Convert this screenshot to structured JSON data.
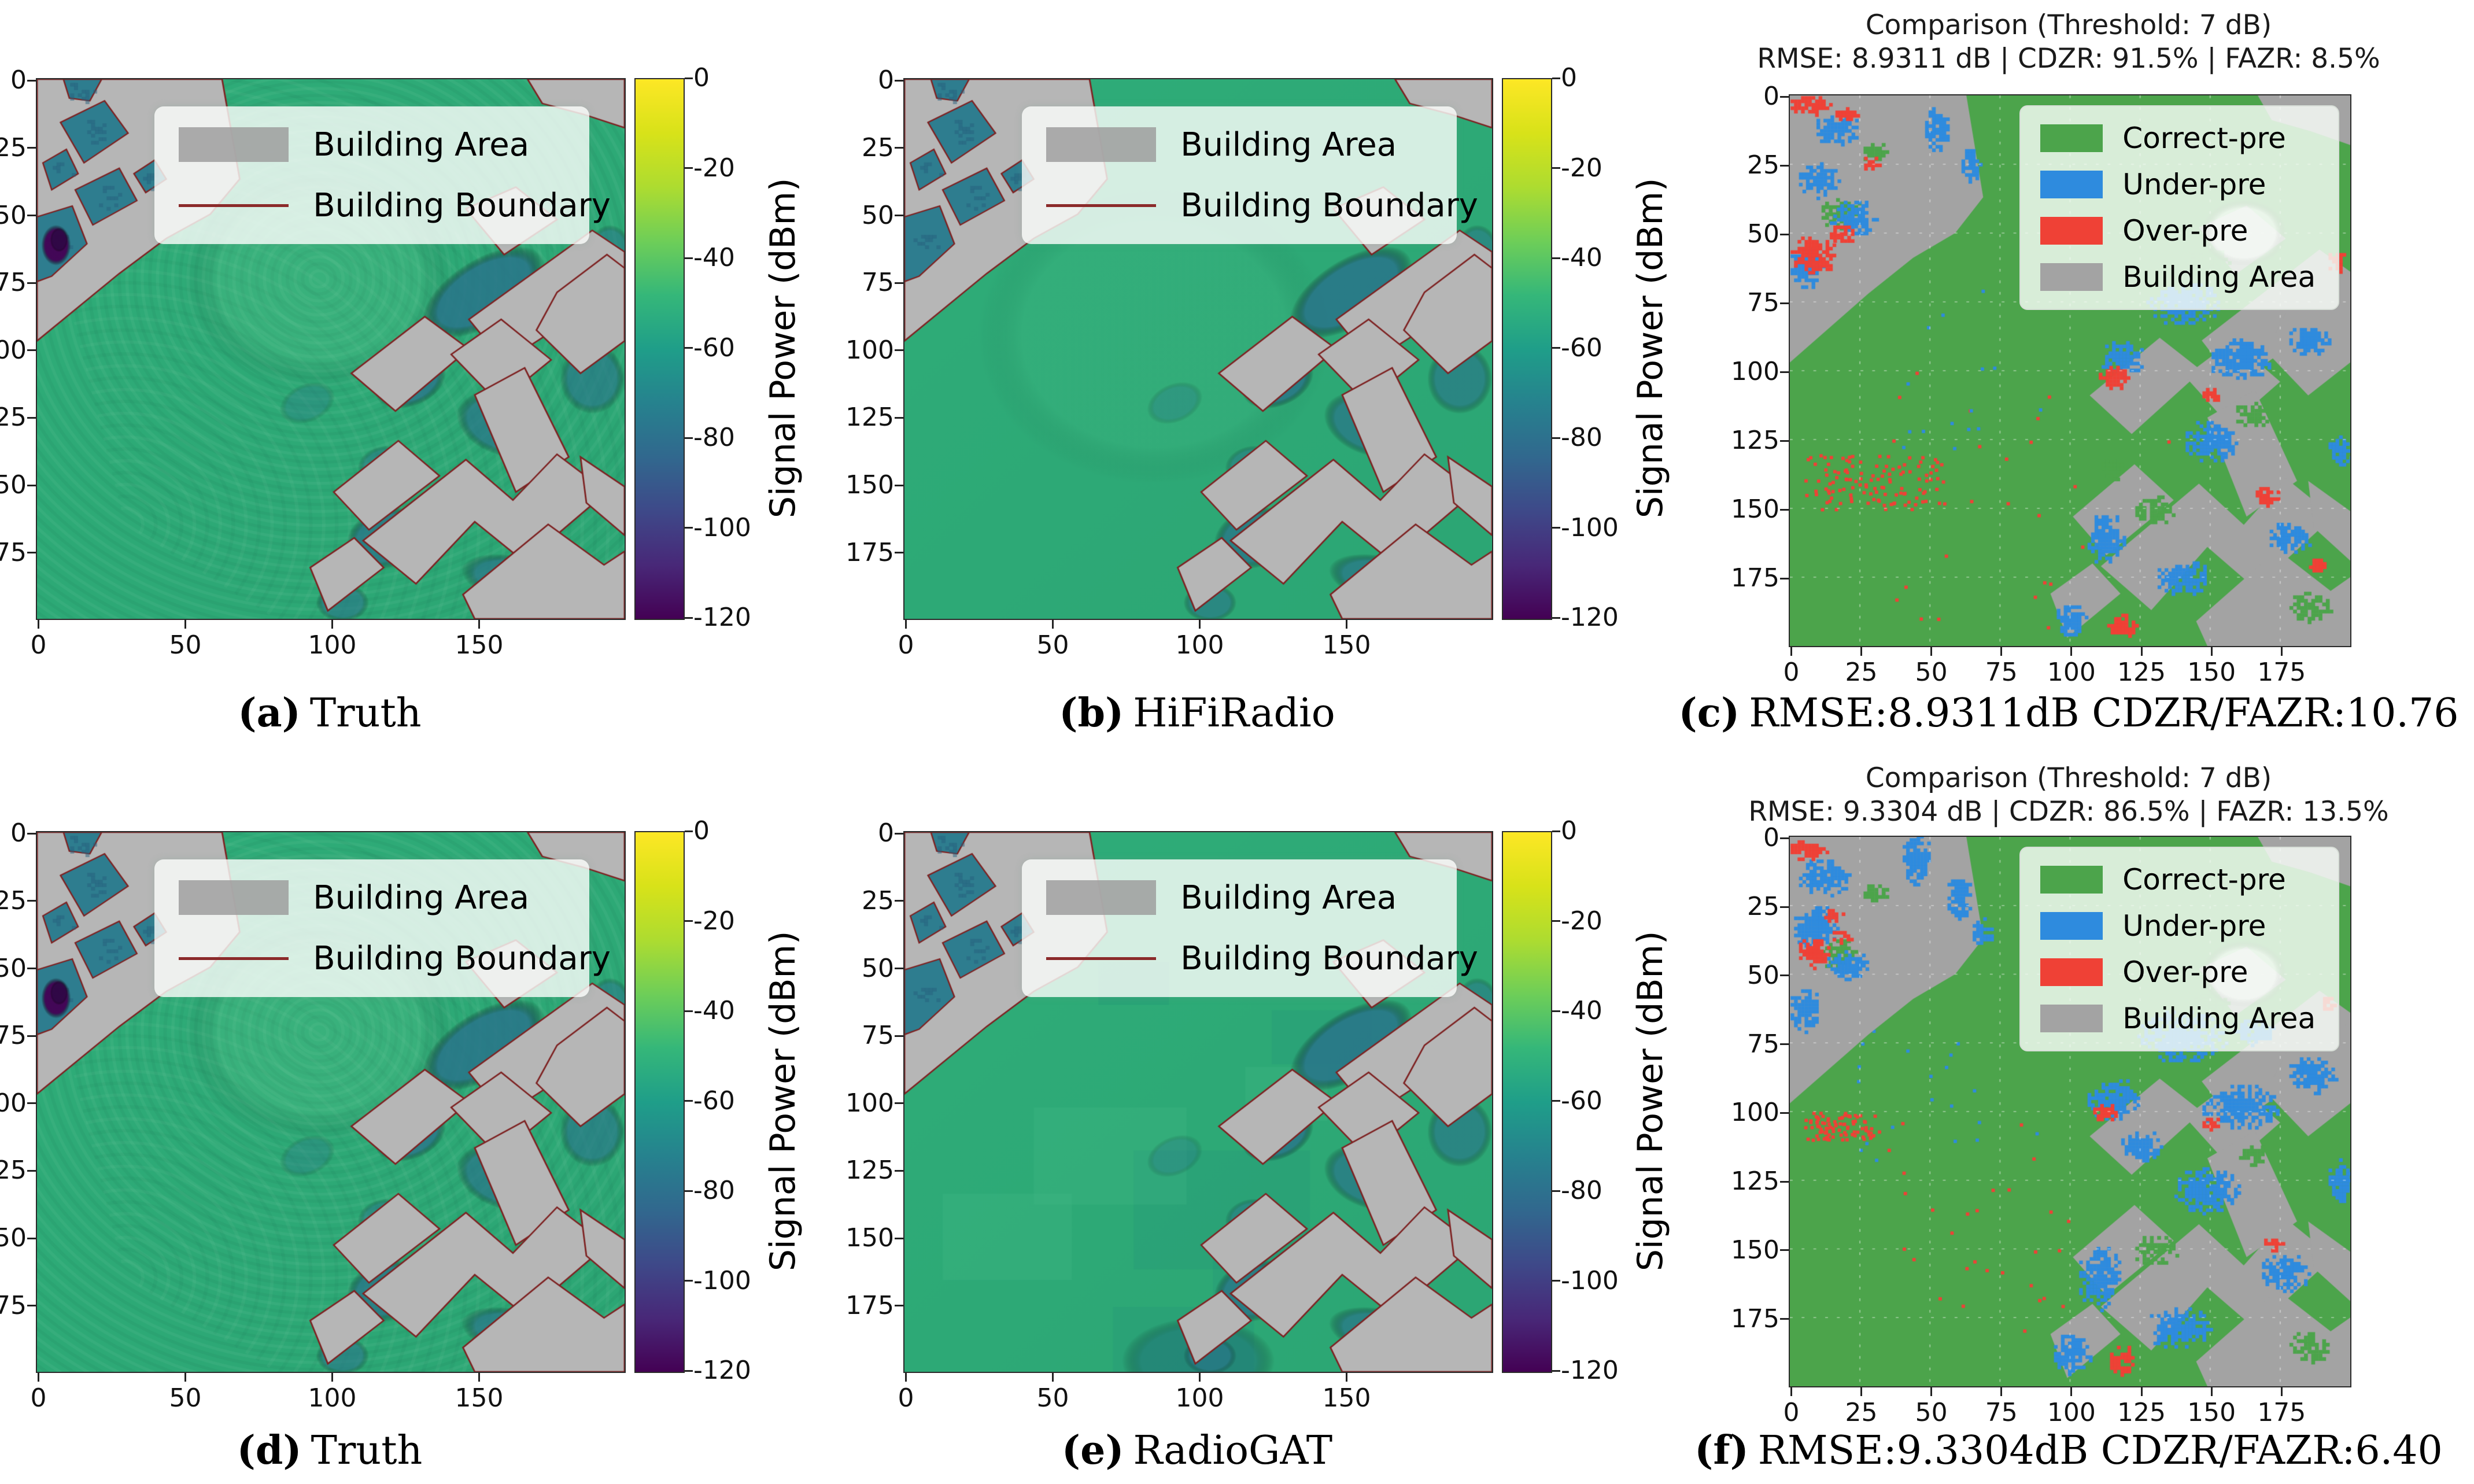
{
  "figure": {
    "background": "#ffffff"
  },
  "colorbar": {
    "label": "Signal Power (dBm)",
    "ticks": [
      "0",
      "-20",
      "-40",
      "-60",
      "-80",
      "-100",
      "-120"
    ],
    "gradient": [
      "#fde725",
      "#d8e219",
      "#addc30",
      "#6ece58",
      "#35b779",
      "#1f9e89",
      "#26828e",
      "#31688e",
      "#3e4989",
      "#482878",
      "#440154"
    ]
  },
  "heatmap_legend": {
    "items": [
      {
        "swatch": "building-area",
        "label": "Building Area"
      },
      {
        "swatch": "building-boundary",
        "label": "Building Boundary"
      }
    ]
  },
  "comparison_legend": {
    "items": [
      {
        "color": "#4CA44B",
        "label": "Correct-pre"
      },
      {
        "color": "#2E8BDE",
        "label": "Under-pre"
      },
      {
        "color": "#EF4136",
        "label": "Over-pre"
      },
      {
        "color": "#A3A3A3",
        "label": "Building Area"
      }
    ]
  },
  "axes": {
    "heatmap_xticks": [
      0,
      50,
      100,
      150
    ],
    "heatmap_yticks": [
      0,
      25,
      50,
      75,
      100,
      125,
      150,
      175
    ],
    "comparison_xticks": [
      0,
      25,
      50,
      75,
      100,
      125,
      150,
      175
    ],
    "comparison_yticks": [
      0,
      25,
      50,
      75,
      100,
      125,
      150,
      175
    ]
  },
  "panels": [
    {
      "id": "a",
      "kind": "heatmap",
      "style": "truth",
      "caption": {
        "tag": "(a)",
        "text": "Truth"
      }
    },
    {
      "id": "b",
      "kind": "heatmap",
      "style": "hifi",
      "caption": {
        "tag": "(b)",
        "text": "HiFiRadio"
      }
    },
    {
      "id": "c",
      "kind": "comparison",
      "diff": "c",
      "title_line1": "Comparison (Threshold: 7 dB)",
      "title_line2": "RMSE: 8.9311 dB | CDZR: 91.5% | FAZR: 8.5%",
      "caption": {
        "tag": "(c)",
        "text": "RMSE:8.9311dB CDZR/FAZR:10.76"
      }
    },
    {
      "id": "d",
      "kind": "heatmap",
      "style": "truth",
      "caption": {
        "tag": "(d)",
        "text": "Truth"
      }
    },
    {
      "id": "e",
      "kind": "heatmap",
      "style": "radiogat",
      "caption": {
        "tag": "(e)",
        "text": "RadioGAT"
      }
    },
    {
      "id": "f",
      "kind": "comparison",
      "diff": "f",
      "title_line1": "Comparison (Threshold: 7 dB)",
      "title_line2": "RMSE: 9.3304 dB | CDZR: 86.5% | FAZR: 13.5%",
      "caption": {
        "tag": "(f)",
        "text": "RMSE:9.3304dB CDZR/FAZR:6.40"
      }
    }
  ],
  "chart_data": {
    "type": "heatmap",
    "x_range": [
      0,
      200
    ],
    "y_range": [
      0,
      200
    ],
    "value_range_dbm": [
      -120,
      0
    ],
    "metrics": {
      "c": {
        "threshold_db": 7,
        "rmse_db": 8.9311,
        "cdzr_pct": 91.5,
        "fazr_pct": 8.5,
        "caption_ratio": 10.76
      },
      "f": {
        "threshold_db": 7,
        "rmse_db": 9.3304,
        "cdzr_pct": 86.5,
        "fazr_pct": 13.5,
        "caption_ratio": 6.4
      }
    },
    "colors": {
      "heatmap_bg": "#2FAD79",
      "building_gray": "#B6B6B6",
      "boundary_red": "#7E2222",
      "courtyard_teal": "#2E7D8F",
      "shadow_teal": "rgba(41,116,138,1)",
      "purple": "#440154",
      "comp_green": "#4CA44B",
      "comp_blue": "#2E8BDE",
      "comp_red": "#EF4136",
      "comp_gray": "#A3A3A3"
    },
    "scene": {
      "tx": [
        96,
        74
      ],
      "buildings": [
        [
          [
            0,
            0
          ],
          [
            63,
            0
          ],
          [
            69,
            37
          ],
          [
            59,
            50
          ],
          [
            44,
            59
          ],
          [
            28,
            72
          ],
          [
            0,
            97
          ]
        ],
        [
          [
            167,
            0
          ],
          [
            200,
            0
          ],
          [
            200,
            18
          ],
          [
            186,
            13
          ],
          [
            172,
            9
          ]
        ],
        [
          [
            146,
            48
          ],
          [
            163,
            40
          ],
          [
            177,
            52
          ],
          [
            159,
            65
          ]
        ],
        [
          [
            147,
            89
          ],
          [
            189,
            56
          ],
          [
            200,
            64
          ],
          [
            200,
            76
          ],
          [
            159,
            105
          ]
        ],
        [
          [
            177,
            79
          ],
          [
            194,
            65
          ],
          [
            200,
            70
          ],
          [
            200,
            97
          ],
          [
            185,
            109
          ],
          [
            170,
            93
          ]
        ],
        [
          [
            107,
            109
          ],
          [
            132,
            88
          ],
          [
            147,
            100
          ],
          [
            122,
            123
          ]
        ],
        [
          [
            141,
            102
          ],
          [
            158,
            89
          ],
          [
            175,
            104
          ],
          [
            157,
            120
          ]
        ],
        [
          [
            149,
            117
          ],
          [
            166,
            107
          ],
          [
            181,
            140
          ],
          [
            163,
            153
          ]
        ],
        [
          [
            101,
            153
          ],
          [
            123,
            134
          ],
          [
            137,
            147
          ],
          [
            113,
            167
          ]
        ],
        [
          [
            111,
            171
          ],
          [
            146,
            141
          ],
          [
            162,
            156
          ],
          [
            177,
            139
          ],
          [
            194,
            153
          ],
          [
            166,
            179
          ],
          [
            149,
            164
          ],
          [
            129,
            187
          ]
        ],
        [
          [
            145,
            191
          ],
          [
            174,
            165
          ],
          [
            193,
            180
          ],
          [
            200,
            175
          ],
          [
            200,
            200
          ],
          [
            149,
            200
          ]
        ],
        [
          [
            93,
            181
          ],
          [
            108,
            170
          ],
          [
            118,
            181
          ],
          [
            99,
            197
          ]
        ],
        [
          [
            185,
            140
          ],
          [
            200,
            151
          ],
          [
            200,
            169
          ],
          [
            187,
            157
          ]
        ]
      ],
      "courtyards": [
        [
          [
            8,
            16
          ],
          [
            23,
            8
          ],
          [
            31,
            20
          ],
          [
            16,
            31
          ]
        ],
        [
          [
            2,
            31
          ],
          [
            10,
            26
          ],
          [
            14,
            35
          ],
          [
            5,
            41
          ]
        ],
        [
          [
            13,
            41
          ],
          [
            28,
            33
          ],
          [
            34,
            45
          ],
          [
            19,
            54
          ]
        ],
        [
          [
            0,
            51
          ],
          [
            12,
            47
          ],
          [
            17,
            61
          ],
          [
            5,
            73
          ],
          [
            0,
            75
          ]
        ],
        [
          [
            33,
            35
          ],
          [
            40,
            30
          ],
          [
            44,
            37
          ],
          [
            37,
            42
          ]
        ],
        [
          [
            9,
            0
          ],
          [
            22,
            0
          ],
          [
            18,
            8
          ],
          [
            11,
            7
          ]
        ]
      ],
      "shadows": [
        [
          152,
          79,
          24,
          12,
          -0.62,
          0.85
        ],
        [
          127,
          112,
          13,
          9,
          -0.5,
          0.8
        ],
        [
          158,
          128,
          16,
          11,
          0.45,
          0.7
        ],
        [
          119,
          170,
          14,
          11,
          -0.4,
          0.75
        ],
        [
          164,
          186,
          20,
          9,
          0.25,
          0.7
        ],
        [
          189,
          111,
          11,
          13,
          0,
          0.65
        ],
        [
          104,
          194,
          9,
          7,
          0,
          0.6
        ],
        [
          195,
          63,
          7,
          9,
          0,
          0.55
        ],
        [
          92,
          120,
          10,
          7,
          -0.5,
          0.35
        ],
        [
          118,
          143,
          9,
          7,
          -0.3,
          0.5
        ]
      ],
      "purple_blob": [
        6.5,
        61.5,
        5,
        7.5
      ],
      "white_wedge_heat": [
        40,
        42,
        16,
        14
      ],
      "white_wedge_comp": [
        162,
        50,
        15,
        12
      ],
      "radiogat_dark_blocks": [
        [
          95,
          190,
          24,
          14
        ],
        [
          120,
          166,
          15,
          11
        ],
        [
          142,
          76,
          17,
          10
        ],
        [
          78,
          56,
          12,
          8
        ],
        [
          108,
          140,
          30,
          22
        ]
      ],
      "radiogat_light_blocks": [
        [
          70,
          120,
          26,
          18
        ],
        [
          35,
          150,
          22,
          16
        ],
        [
          130,
          97,
          14,
          10
        ]
      ]
    },
    "comparisons": {
      "c": {
        "blue": [
          [
            16,
            12,
            9,
            6
          ],
          [
            10,
            30,
            8,
            7
          ],
          [
            22,
            44,
            9,
            7
          ],
          [
            6,
            62,
            7,
            8
          ],
          [
            52,
            12,
            5,
            9
          ],
          [
            64,
            24,
            4,
            7
          ],
          [
            140,
            75,
            14,
            8
          ],
          [
            118,
            95,
            8,
            7
          ],
          [
            160,
            95,
            12,
            8
          ],
          [
            150,
            125,
            10,
            8
          ],
          [
            185,
            88,
            8,
            6
          ],
          [
            112,
            160,
            7,
            10
          ],
          [
            140,
            175,
            10,
            7
          ],
          [
            178,
            160,
            8,
            6
          ],
          [
            100,
            190,
            6,
            6
          ],
          [
            196,
            128,
            5,
            7
          ]
        ],
        "red": [
          [
            7,
            3,
            8,
            4
          ],
          [
            20,
            6,
            5,
            3
          ],
          [
            8,
            58,
            9,
            8
          ],
          [
            18,
            50,
            5,
            4
          ],
          [
            28,
            24,
            4,
            3
          ],
          [
            115,
            102,
            6,
            5
          ],
          [
            150,
            108,
            4,
            3
          ],
          [
            170,
            145,
            5,
            4
          ],
          [
            118,
            192,
            6,
            5
          ],
          [
            188,
            170,
            4,
            3
          ],
          [
            195,
            60,
            4,
            4
          ]
        ],
        "green_patches": [
          [
            18,
            42,
            8,
            6
          ],
          [
            30,
            20,
            5,
            4
          ],
          [
            150,
            60,
            8,
            5
          ],
          [
            130,
            150,
            8,
            6
          ],
          [
            165,
            115,
            7,
            5
          ],
          [
            185,
            185,
            8,
            6
          ],
          [
            115,
            135,
            5,
            4
          ]
        ],
        "speckles": [
          [
            120,
            5,
            130,
            55,
            150,
            "red"
          ],
          [
            30,
            30,
            100,
            140,
            195,
            "red"
          ],
          [
            15,
            20,
            60,
            90,
            130,
            "blue"
          ]
        ]
      },
      "f": {
        "blue": [
          [
            12,
            14,
            10,
            7
          ],
          [
            8,
            32,
            9,
            8
          ],
          [
            20,
            46,
            8,
            6
          ],
          [
            5,
            62,
            6,
            9
          ],
          [
            45,
            8,
            6,
            10
          ],
          [
            60,
            22,
            5,
            9
          ],
          [
            68,
            34,
            4,
            6
          ],
          [
            140,
            72,
            16,
            10
          ],
          [
            115,
            95,
            10,
            8
          ],
          [
            160,
            98,
            14,
            9
          ],
          [
            148,
            128,
            12,
            9
          ],
          [
            186,
            86,
            9,
            7
          ],
          [
            110,
            160,
            8,
            12
          ],
          [
            138,
            178,
            12,
            8
          ],
          [
            176,
            158,
            10,
            7
          ],
          [
            100,
            188,
            7,
            8
          ],
          [
            196,
            125,
            5,
            8
          ],
          [
            125,
            112,
            8,
            6
          ],
          [
            165,
            70,
            8,
            6
          ]
        ],
        "red": [
          [
            6,
            4,
            7,
            4
          ],
          [
            15,
            28,
            4,
            3
          ],
          [
            8,
            42,
            6,
            6
          ],
          [
            18,
            36,
            4,
            3
          ],
          [
            112,
            100,
            5,
            4
          ],
          [
            150,
            104,
            4,
            3
          ],
          [
            118,
            190,
            5,
            6
          ],
          [
            172,
            148,
            4,
            3
          ],
          [
            192,
            60,
            3,
            3
          ]
        ],
        "green_patches": [
          [
            18,
            42,
            8,
            6
          ],
          [
            30,
            20,
            5,
            4
          ],
          [
            150,
            60,
            7,
            4
          ],
          [
            130,
            150,
            8,
            6
          ],
          [
            165,
            115,
            6,
            4
          ],
          [
            185,
            185,
            8,
            6
          ]
        ],
        "speckles": [
          [
            90,
            5,
            110,
            30,
            100,
            "red"
          ],
          [
            30,
            30,
            100,
            100,
            180,
            "red"
          ],
          [
            20,
            20,
            70,
            90,
            120,
            "blue"
          ]
        ]
      }
    }
  }
}
